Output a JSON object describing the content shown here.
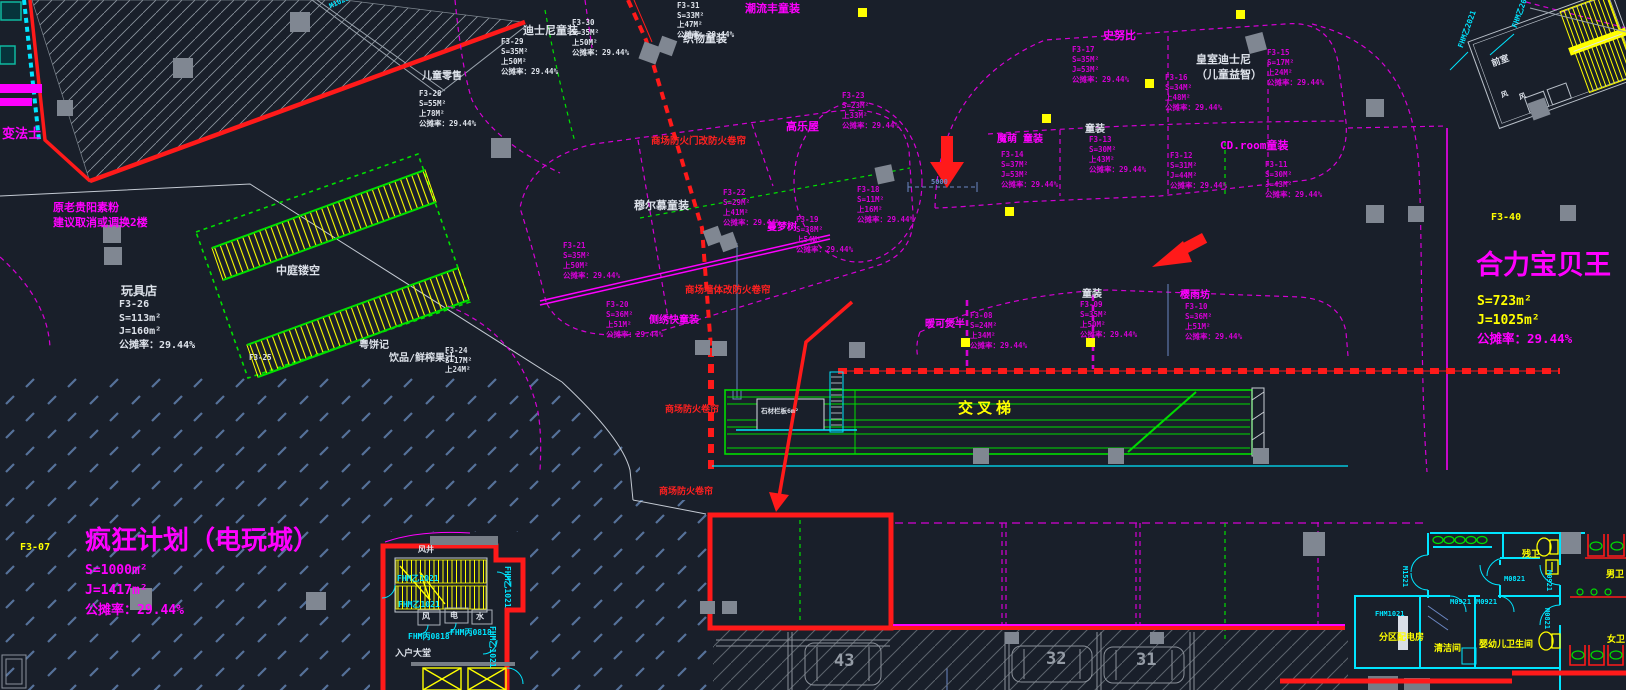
{
  "palette": {
    "mag": "#d400d4",
    "bmag": "#ff00ff",
    "white": "#dde2ea",
    "yellow": "#ffff00",
    "red": "#ff2020",
    "cyan": "#00e5ff",
    "green": "#00dc00",
    "blue": "#6b87c4",
    "gray": "#959ca6"
  },
  "labels": [
    {
      "n": "bianfashi",
      "t": "变法士",
      "x": 2,
      "y": 126,
      "s": 13,
      "c": "bmag"
    },
    {
      "n": "note-relocate",
      "t": [
        "原老贵阳素粉",
        "建议取消或调换2楼"
      ],
      "x": 53,
      "y": 200,
      "s": 11,
      "c": "bmag",
      "lh": 15
    },
    {
      "n": "ertong-lingshou",
      "t": "儿童零售",
      "x": 422,
      "y": 70,
      "s": 10,
      "c": "white"
    },
    {
      "n": "f3-28",
      "t": [
        "F3-28",
        "S=55M²",
        "上78M²",
        "公摊率：29.44%"
      ],
      "x": 419,
      "y": 89,
      "s": 7.5,
      "c": "white",
      "lh": 10
    },
    {
      "n": "disney-tongzhuang",
      "t": "迪士尼童装",
      "x": 523,
      "y": 24,
      "s": 11,
      "c": "white"
    },
    {
      "n": "f3-30",
      "t": [
        "F3-30",
        "S=35M²",
        "上50M²",
        "公摊率：29.44%"
      ],
      "x": 572,
      "y": 18,
      "s": 7.5,
      "c": "white",
      "lh": 10
    },
    {
      "n": "f3-29",
      "t": [
        "F3-29",
        "S=35M²",
        "上50M²",
        "公摊率：29.44%"
      ],
      "x": 501,
      "y": 37,
      "s": 7.5,
      "c": "white",
      "lh": 10
    },
    {
      "n": "f3-31",
      "t": [
        "F3-31",
        "S=33M²",
        "上47M²",
        "公摊率：29.44%"
      ],
      "x": 677,
      "y": 1,
      "s": 7.5,
      "c": "white",
      "lh": 9.5
    },
    {
      "n": "zhiwu-tongzhuang",
      "t": "织物童装",
      "x": 683,
      "y": 32,
      "s": 11,
      "c": "white"
    },
    {
      "n": "chaoliu-tongzhuang",
      "t": "潮流丰童装",
      "x": 745,
      "y": 2,
      "s": 11,
      "c": "bmag"
    },
    {
      "n": "f3-23",
      "t": [
        "F3-23",
        "S=23M²",
        "上33M²",
        "公摊率：29.44%"
      ],
      "x": 842,
      "y": 91,
      "s": 7.5,
      "c": "mag",
      "lh": 10
    },
    {
      "n": "gaolewu",
      "t": "高乐屋",
      "x": 786,
      "y": 120,
      "s": 11,
      "c": "bmag"
    },
    {
      "n": "f3-18",
      "t": [
        "F3-18",
        "S=11M²",
        "上16M²",
        "公摊率：29.44%"
      ],
      "x": 857,
      "y": 185,
      "s": 7.5,
      "c": "mag",
      "lh": 10
    },
    {
      "n": "f3-19",
      "t": [
        "F3-19",
        "S=38M²",
        "上54M²",
        "公摊率：29.44%"
      ],
      "x": 796,
      "y": 215,
      "s": 7.5,
      "c": "mag",
      "lh": 10
    },
    {
      "n": "mengmengshu",
      "t": "蔓梦树",
      "x": 767,
      "y": 221,
      "s": 10,
      "c": "bmag"
    },
    {
      "n": "f3-22",
      "t": [
        "F3-22",
        "S=29M²",
        "上41M²",
        "公摊率：29.44%"
      ],
      "x": 723,
      "y": 188,
      "s": 7.5,
      "c": "mag",
      "lh": 10
    },
    {
      "n": "muermu-tongzhuang",
      "t": "穆尔慕童装",
      "x": 634,
      "y": 199,
      "s": 11,
      "c": "white"
    },
    {
      "n": "f3-21",
      "t": [
        "F3-21",
        "S=35M²",
        "上50M²",
        "公摊率：29.44%"
      ],
      "x": 563,
      "y": 241,
      "s": 7.5,
      "c": "mag",
      "lh": 10
    },
    {
      "n": "f3-20",
      "t": [
        "F3-20",
        "S=36M²",
        "上51M²",
        "公摊率：29.44%"
      ],
      "x": 606,
      "y": 300,
      "s": 7.5,
      "c": "mag",
      "lh": 10
    },
    {
      "n": "cexiu-tongzhuang",
      "t": "侧绣快童装",
      "x": 649,
      "y": 314,
      "s": 10,
      "c": "bmag"
    },
    {
      "n": "note-firedoor",
      "t": "商场防火门改防火卷帘",
      "x": 651,
      "y": 136,
      "s": 9.5,
      "c": "red"
    },
    {
      "n": "note-firewall",
      "t": "商场墙体改防火卷帘",
      "x": 685,
      "y": 285,
      "s": 9.5,
      "c": "red"
    },
    {
      "n": "note-shutter1",
      "t": "商场防火卷帘",
      "x": 665,
      "y": 404,
      "s": 9,
      "c": "red"
    },
    {
      "n": "note-shutter2",
      "t": "商场防火卷帘",
      "x": 659,
      "y": 486,
      "s": 9,
      "c": "red"
    },
    {
      "n": "snoopy",
      "t": "史努比",
      "x": 1103,
      "y": 29,
      "s": 11,
      "c": "bmag"
    },
    {
      "n": "f3-17",
      "t": [
        "F3-17",
        "S=35M²",
        "J=53M²",
        "公摊率：29.44%"
      ],
      "x": 1072,
      "y": 45,
      "s": 7.5,
      "c": "mag",
      "lh": 10
    },
    {
      "n": "royal-disney",
      "t": [
        "皇室迪士尼",
        "（儿童益智）"
      ],
      "x": 1196,
      "y": 52,
      "s": 11,
      "c": "white",
      "lh": 15
    },
    {
      "n": "f3-15",
      "t": [
        "F3-15",
        "S=17M²",
        "上24M²",
        "公摊率：29.44%"
      ],
      "x": 1267,
      "y": 48,
      "s": 7.5,
      "c": "mag",
      "lh": 10
    },
    {
      "n": "f3-16",
      "t": [
        "F3-16",
        "S=34M²",
        "上48M²",
        "公摊率：29.44%"
      ],
      "x": 1165,
      "y": 73,
      "s": 7.5,
      "c": "mag",
      "lh": 10
    },
    {
      "n": "tongzhuang-a",
      "t": "童装",
      "x": 1085,
      "y": 123,
      "s": 10,
      "c": "white"
    },
    {
      "n": "f3-13",
      "t": [
        "F3-13",
        "S=30M²",
        "上43M²",
        "公摊率：29.44%"
      ],
      "x": 1089,
      "y": 135,
      "s": 7.5,
      "c": "mag",
      "lh": 10
    },
    {
      "n": "momeng-tongzhuang",
      "t": "魔萌 童装",
      "x": 997,
      "y": 133,
      "s": 10,
      "c": "bmag"
    },
    {
      "n": "f3-14",
      "t": [
        "F3-14",
        "S=37M²",
        "J=53M²",
        "公摊率：29.44%"
      ],
      "x": 1001,
      "y": 150,
      "s": 7.5,
      "c": "mag",
      "lh": 10
    },
    {
      "n": "cdroom-tongzhuang",
      "t": "CD.room童装",
      "x": 1220,
      "y": 139,
      "s": 11,
      "c": "bmag"
    },
    {
      "n": "f3-12",
      "t": [
        "F3-12",
        "S=31M²",
        "J=44M²",
        "公摊率：29.44%"
      ],
      "x": 1170,
      "y": 151,
      "s": 7.5,
      "c": "mag",
      "lh": 10
    },
    {
      "n": "f3-11",
      "t": [
        "F3-11",
        "S=30M²",
        "J=43M²",
        "公摊率：29.44%"
      ],
      "x": 1265,
      "y": 160,
      "s": 7.5,
      "c": "mag",
      "lh": 10
    },
    {
      "n": "f3-40",
      "t": "F3-40",
      "x": 1491,
      "y": 211,
      "s": 10,
      "c": "yellow"
    },
    {
      "n": "heli-baobeiwang",
      "t": "合力宝贝王",
      "x": 1476,
      "y": 248,
      "s": 27,
      "c": "bmag"
    },
    {
      "n": "heli-s",
      "t": "S=723m²",
      "x": 1477,
      "y": 293,
      "s": 13,
      "c": "yellow"
    },
    {
      "n": "heli-j",
      "t": "J=1025m²",
      "x": 1477,
      "y": 312,
      "s": 13,
      "c": "yellow"
    },
    {
      "n": "heli-rate",
      "t": "公摊率：29.44%",
      "x": 1477,
      "y": 331,
      "s": 12.5,
      "c": "bmag"
    },
    {
      "n": "nuanke",
      "t": "暖可煲半",
      "x": 925,
      "y": 318,
      "s": 10,
      "c": "bmag"
    },
    {
      "n": "f3-08",
      "t": [
        "F3-08",
        "S=24M²",
        "上34M²",
        "公摊率：29.44%"
      ],
      "x": 970,
      "y": 311,
      "s": 7.5,
      "c": "mag",
      "lh": 10
    },
    {
      "n": "tongzhuang-b",
      "t": "童装",
      "x": 1082,
      "y": 288,
      "s": 10,
      "c": "white"
    },
    {
      "n": "f3-09",
      "t": [
        "F3-09",
        "S=35M²",
        "上50M²",
        "公摊率：29.44%"
      ],
      "x": 1080,
      "y": 300,
      "s": 7.5,
      "c": "mag",
      "lh": 10
    },
    {
      "n": "yingyufang",
      "t": "樱雨坊",
      "x": 1180,
      "y": 289,
      "s": 10,
      "c": "bmag"
    },
    {
      "n": "f3-10",
      "t": [
        "F3-10",
        "S=36M²",
        "上51M²",
        "公摊率：29.44%"
      ],
      "x": 1185,
      "y": 302,
      "s": 7.5,
      "c": "mag",
      "lh": 10
    },
    {
      "n": "jiaochati",
      "t": "交叉梯",
      "x": 958,
      "y": 398,
      "s": 15,
      "c": "yellow",
      "ls": 4
    },
    {
      "n": "shicai-note",
      "t": "石材栏板6m²",
      "x": 761,
      "y": 407,
      "s": 6.5,
      "c": "white"
    },
    {
      "n": "wanjudian",
      "t": "玩具店",
      "x": 121,
      "y": 283,
      "s": 12,
      "c": "white"
    },
    {
      "n": "f3-26",
      "t": [
        "F3-26",
        "S=113m²",
        "J=160m²",
        "公摊率：29.44%"
      ],
      "x": 119,
      "y": 298,
      "s": 10,
      "c": "white",
      "lh": 13.5
    },
    {
      "n": "zhongting-loukong",
      "t": "中庭镂空",
      "x": 276,
      "y": 264,
      "s": 11,
      "c": "white"
    },
    {
      "n": "yuebingji",
      "t": "粤饼记",
      "x": 359,
      "y": 339,
      "s": 10,
      "c": "white"
    },
    {
      "n": "yinpin-guozhi",
      "t": "饮品/鲜榨果汁",
      "x": 389,
      "y": 352,
      "s": 10,
      "c": "white"
    },
    {
      "n": "f3-24",
      "t": [
        "F3-24",
        "S=17M²",
        "上24M²"
      ],
      "x": 445,
      "y": 346,
      "s": 7.5,
      "c": "white",
      "lh": 9.5
    },
    {
      "n": "f3-25",
      "t": "F3-25",
      "x": 249,
      "y": 353,
      "s": 7.5,
      "c": "white"
    },
    {
      "n": "fengkuang-jihua",
      "t": "疯狂计划（电玩城）",
      "x": 85,
      "y": 524,
      "s": 26,
      "c": "bmag"
    },
    {
      "n": "fk-s",
      "t": "S=1000m²",
      "x": 85,
      "y": 562,
      "s": 13,
      "c": "bmag"
    },
    {
      "n": "fk-j",
      "t": "J=1417m²",
      "x": 85,
      "y": 582,
      "s": 13,
      "c": "bmag"
    },
    {
      "n": "fk-rate",
      "t": "公摊率：29.44%",
      "x": 85,
      "y": 602,
      "s": 13,
      "c": "bmag"
    },
    {
      "n": "f3-07",
      "t": "F3-07",
      "x": 20,
      "y": 541,
      "s": 10,
      "c": "yellow"
    },
    {
      "n": "ruhu-datang",
      "t": "入户大堂",
      "x": 395,
      "y": 648,
      "s": 9,
      "c": "white"
    },
    {
      "n": "shaft-feng",
      "t": "风",
      "x": 422,
      "y": 612,
      "s": 8,
      "c": "white"
    },
    {
      "n": "shaft-dian",
      "t": "电",
      "x": 450,
      "y": 611,
      "s": 8,
      "c": "white"
    },
    {
      "n": "shaft-shui",
      "t": "水",
      "x": 476,
      "y": 612,
      "s": 8,
      "c": "white"
    },
    {
      "n": "fengjing",
      "t": "风井",
      "x": 418,
      "y": 545,
      "s": 8,
      "c": "white"
    },
    {
      "n": "fhm-a",
      "t": "FHM乙1021",
      "x": 397,
      "y": 574,
      "s": 8,
      "c": "cyan"
    },
    {
      "n": "fhm-b",
      "t": "FHM乙1021",
      "x": 398,
      "y": 600,
      "s": 8,
      "c": "cyan"
    },
    {
      "n": "fhm-c",
      "t": "FHM乙1021",
      "x": 512,
      "y": 566,
      "s": 8,
      "c": "cyan",
      "r": 90
    },
    {
      "n": "fhm-d",
      "t": "FHM丙0818",
      "x": 408,
      "y": 632,
      "s": 8,
      "c": "cyan"
    },
    {
      "n": "fhm-e",
      "t": "FHM丙0818",
      "x": 450,
      "y": 628,
      "s": 8,
      "c": "cyan"
    },
    {
      "n": "fhm-f",
      "t": "FHM乙1021",
      "x": 497,
      "y": 626,
      "s": 8,
      "c": "cyan",
      "r": 90
    },
    {
      "n": "canwei",
      "t": "残卫",
      "x": 1522,
      "y": 549,
      "s": 9,
      "c": "yellow"
    },
    {
      "n": "nanwei",
      "t": "男卫",
      "x": 1606,
      "y": 569,
      "s": 9,
      "c": "yellow"
    },
    {
      "n": "nvwei",
      "t": "女卫",
      "x": 1607,
      "y": 634,
      "s": 9,
      "c": "yellow"
    },
    {
      "n": "yingyouer-wsj",
      "t": "婴幼儿卫生间",
      "x": 1479,
      "y": 639,
      "s": 9,
      "c": "yellow"
    },
    {
      "n": "qingjiejian",
      "t": "清洁间",
      "x": 1434,
      "y": 643,
      "s": 9,
      "c": "yellow"
    },
    {
      "n": "peidianfang",
      "t": "分区配电房",
      "x": 1379,
      "y": 632,
      "s": 9,
      "c": "yellow"
    },
    {
      "n": "m1521",
      "t": "M1521",
      "x": 1409,
      "y": 566,
      "s": 7,
      "c": "cyan",
      "r": 90
    },
    {
      "n": "m0821-a",
      "t": "M0821",
      "x": 1504,
      "y": 575,
      "s": 7,
      "c": "cyan"
    },
    {
      "n": "m0921-a",
      "t": "M0921",
      "x": 1450,
      "y": 598,
      "s": 7,
      "c": "cyan"
    },
    {
      "n": "m0921-b",
      "t": "M0921",
      "x": 1476,
      "y": 598,
      "s": 7,
      "c": "cyan"
    },
    {
      "n": "m0921-c",
      "t": "M0921",
      "x": 1553,
      "y": 570,
      "s": 7,
      "c": "cyan",
      "r": 90
    },
    {
      "n": "m0821-b",
      "t": "M0821",
      "x": 1551,
      "y": 608,
      "s": 7,
      "c": "cyan",
      "r": 90
    },
    {
      "n": "fhm1021",
      "t": "FHM1021",
      "x": 1375,
      "y": 610,
      "s": 7,
      "c": "cyan"
    },
    {
      "n": "qianshi",
      "t": "前室",
      "x": 1490,
      "y": 59,
      "s": 9,
      "c": "white",
      "r": -20
    },
    {
      "n": "fhm2021-a",
      "t": "FHM乙2021",
      "x": 1510,
      "y": 26,
      "s": 7.5,
      "c": "cyan",
      "r": -70
    },
    {
      "n": "fhm2021-b",
      "t": "FHM乙2021",
      "x": 1456,
      "y": 46,
      "s": 7.5,
      "c": "cyan",
      "r": -70
    },
    {
      "n": "feng-tr-a",
      "t": "风",
      "x": 1500,
      "y": 92,
      "s": 7,
      "c": "white",
      "r": -20
    },
    {
      "n": "feng-tr-b",
      "t": "风",
      "x": 1518,
      "y": 94,
      "s": 7,
      "c": "white",
      "r": -20
    },
    {
      "n": "m1021-top",
      "t": "M1021",
      "x": 328,
      "y": 3,
      "s": 7,
      "c": "cyan",
      "r": -25
    },
    {
      "n": "dim-5000",
      "t": "5000",
      "x": 931,
      "y": 178,
      "s": 7,
      "c": "blue"
    },
    {
      "n": "parking-43",
      "t": "43",
      "x": 834,
      "y": 650,
      "s": 17,
      "c": "gray"
    },
    {
      "n": "parking-32",
      "t": "32",
      "x": 1046,
      "y": 648,
      "s": 17,
      "c": "gray"
    },
    {
      "n": "parking-31",
      "t": "31",
      "x": 1136,
      "y": 649,
      "s": 17,
      "c": "gray"
    }
  ]
}
